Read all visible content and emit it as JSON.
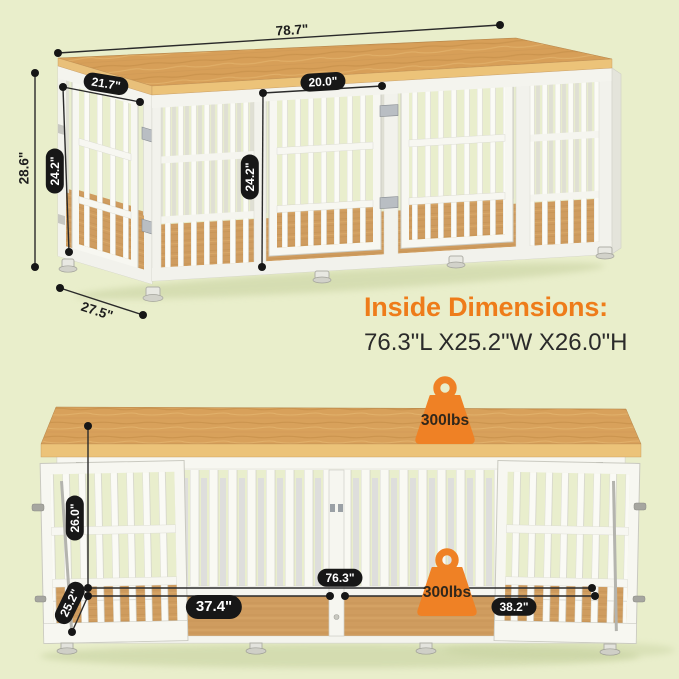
{
  "isometric_view": {
    "overall_width_label": "78.7\"",
    "side_top_width_label": "21.7\"",
    "front_door_width_label": "20.0\"",
    "overall_height_label": "28.6\"",
    "side_door_height_label": "24.2\"",
    "front_door_height_label": "24.2\"",
    "overall_depth_label": "27.5\""
  },
  "inside_dimensions": {
    "heading": "Inside Dimensions:",
    "value": "76.3\"L X25.2\"W X26.0\"H"
  },
  "front_view": {
    "inner_height_label": "26.0\"",
    "inner_depth_label": "25.2\"",
    "inner_width_label": "76.3\"",
    "left_room_width_label": "37.4\"",
    "right_room_width_label": "38.2\"",
    "tabletop_capacity_label": "300lbs",
    "interior_capacity_label": "300lbs"
  },
  "colors": {
    "background": "#e9eecb",
    "accent_orange": "#ef8125",
    "heading_orange": "#ee7c1a",
    "wood": "#d8a15b",
    "label_pill_background": "#171717",
    "label_pill_text": "#ffffff",
    "dimension_line": "#2a2a2a"
  }
}
